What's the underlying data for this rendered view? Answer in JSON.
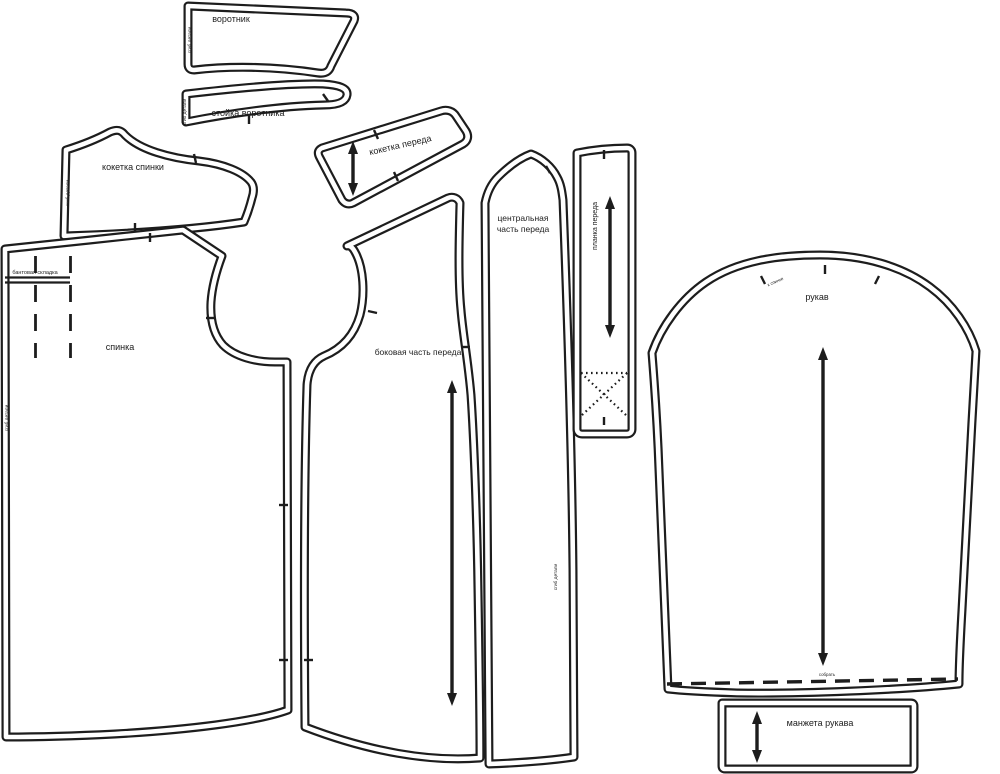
{
  "pieces": {
    "collar": {
      "label": "воротник"
    },
    "collar_stand": {
      "label": "стойка воротника"
    },
    "back_yoke": {
      "label": "кокетка спинки"
    },
    "front_yoke": {
      "label": "кокетка переда"
    },
    "back": {
      "label": "спинка",
      "pleat_label": "бантовая складка"
    },
    "side_front": {
      "label": "боковая часть переда"
    },
    "center_front": {
      "label_line1": "центральная",
      "label_line2": "часть переда"
    },
    "placket": {
      "label": "планка переда"
    },
    "sleeve": {
      "label": "рукав",
      "hem_note": "собрать",
      "cap_note": "к спинке"
    },
    "cuff": {
      "label": "манжета рукава"
    }
  },
  "annotations": {
    "fold_note": "сгиб детали"
  },
  "colors": {
    "line": "#1d1d1d",
    "background": "#ffffff"
  }
}
